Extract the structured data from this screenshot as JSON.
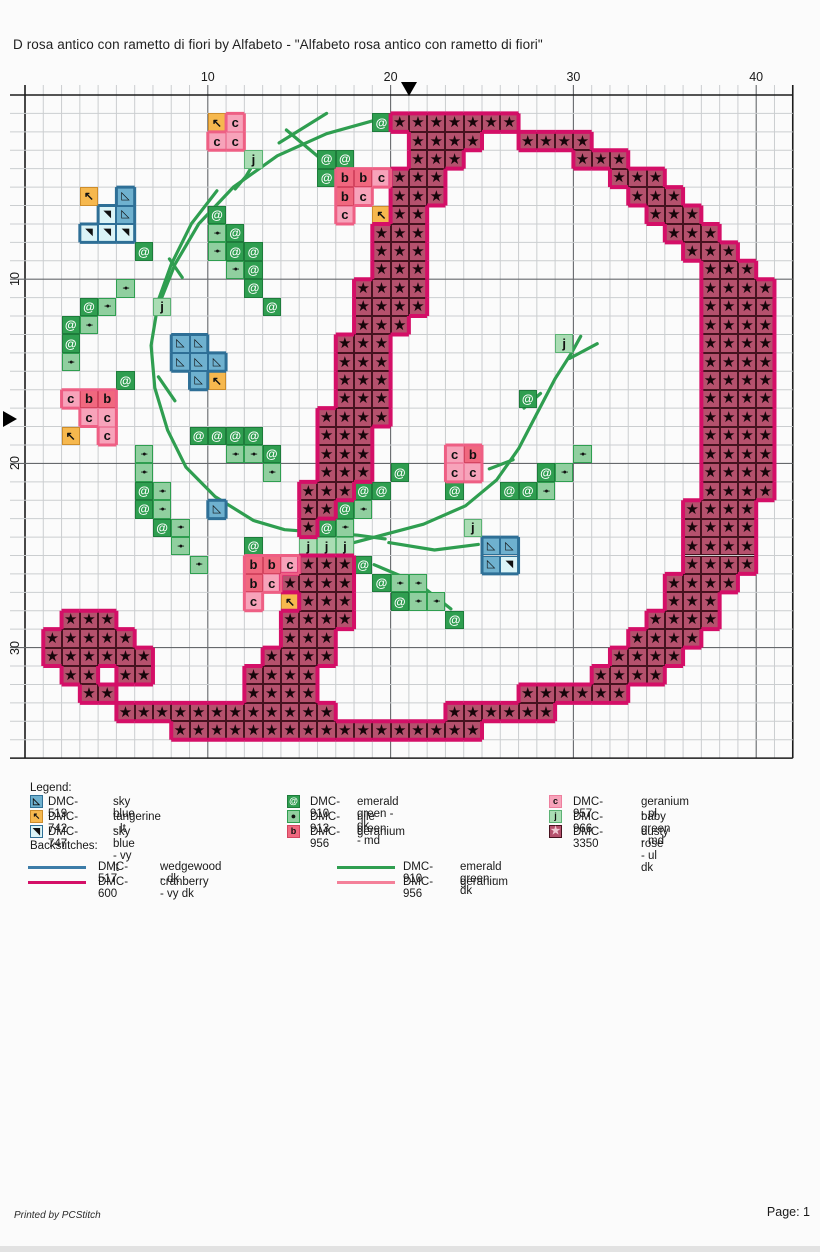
{
  "title": "D rosa antico con rametto di fiori by Alfabeto - \"Alfabeto rosa antico con rametto di fiori\"",
  "chart": {
    "grid": {
      "cols": 42,
      "rows": 36,
      "origin_x": 25,
      "origin_y": 95,
      "cell_w": 18.28,
      "cell_h": 18.42,
      "ruler_top": [
        10,
        20,
        30,
        40
      ],
      "ruler_left": [
        10,
        20,
        30
      ],
      "center_col": 21,
      "center_row": 17.6,
      "minor_line_color": "#cbced0",
      "major_line_color": "#66696c",
      "border_color": "#1c1c1c"
    },
    "palette": {
      "*": {
        "dmc": "DMC-3350",
        "fill": "#b5516d",
        "border": "#46121f",
        "sym": "★",
        "symColor": "#16050a",
        "size": 15,
        "weight": 400
      },
      "c": {
        "dmc": "DMC-957",
        "fill": "#f7a3ba",
        "border": "#ee7f9e",
        "sym": "c",
        "symColor": "#111111",
        "size": 13,
        "weight": 700
      },
      "b": {
        "dmc": "DMC-956",
        "fill": "#f0687f",
        "border": "#d44560",
        "sym": "b",
        "symColor": "#111111",
        "size": 13,
        "weight": 700
      },
      "e": {
        "dmc": "DMC-910",
        "fill": "#2f9e50",
        "border": "#1d7c3b",
        "sym": "@",
        "symColor": "#ffffff",
        "size": 12,
        "weight": 700
      },
      "n": {
        "dmc": "DMC-913",
        "fill": "#90cf9f",
        "border": "#2f9e50",
        "sym": "-●-",
        "symColor": "#111111",
        "size": 7,
        "weight": 700
      },
      "j": {
        "dmc": "DMC-966",
        "fill": "#aaddb4",
        "border": "#5cb274",
        "sym": "j",
        "symColor": "#111111",
        "size": 13,
        "weight": 700
      },
      "A": {
        "dmc": "DMC-519",
        "fill": "#6fb1cf",
        "border": "#2e6f96",
        "sym": "◺",
        "symColor": "#111111",
        "size": 11,
        "weight": 400
      },
      "V": {
        "dmc": "DMC-747",
        "fill": "#dbf4f7",
        "border": "#2e6f96",
        "sym": "◥",
        "symColor": "#111111",
        "size": 10,
        "weight": 400
      },
      "t": {
        "dmc": "DMC-742",
        "fill": "#f6b84e",
        "border": "#cd8d2c",
        "sym": "↖",
        "symColor": "#111111",
        "size": 12,
        "weight": 700
      }
    },
    "outline_groups": [
      {
        "name": "cranberry-outline",
        "keys": [
          "*"
        ],
        "color": "#d40f67",
        "width": 4
      },
      {
        "name": "wedgewood-outline",
        "keys": [
          "A",
          "V"
        ],
        "color": "#2e6f96",
        "width": 3
      },
      {
        "name": "geranium-outline",
        "keys": [
          "c",
          "b"
        ],
        "color": "#ee5f84",
        "width": 3
      }
    ],
    "pattern_rows": [
      "..........................................",
      "..........tc.......e*******...............",
      "..........cc.........****..****...........",
      "............j...ee...***......***.........",
      "................ebbc***.........***.......",
      "...t.A...........bc.***..........***......",
      "....VA....e......c.t**............***.....",
      "...VVV....ne.......***.............***....",
      "......e...nee......***..............***...",
      "...........ne......***...............***..",
      ".....n......e.....****...............****.",
      "...en..j.....e....****...............****.",
      "..en..............***................****.",
      "..e.....AA.......***.........j.......****.",
      "..n.....AAA......***.................****.",
      ".....e...At......***.................****.",
      "..cbb............***.......e.........****.",
      "...cc...........****.................****.",
      "..t.c....eeee...***..................****.",
      "......n....nne..***....cb.....n......****.",
      "......n......n..***.e..cc...en.......****.",
      "......en.......***ee...e..een........****.",
      "......en..A....**en.................****..",
      ".......en......*en......j...........****..",
      "........n...e..jjj.......AA.........****..",
      ".........n..bbc***e......AV.........****..",
      "............bc****.enn.............****...",
      "............c.t***..enn............***....",
      "..***.........****.....e..........****....",
      ".*****........***................****.....",
      ".******......****...............****......",
      "..**.**.....****...............****.......",
      "...**.......****...........******.........",
      ".....************......******.............",
      "........*****************.................",
      ".........................................."
    ],
    "backstitch_color": "#2f9e50",
    "backstitch_width": 3.2,
    "backstitch_paths": [
      [
        [
          19.4,
          1.3
        ],
        [
          16.5,
          2.1
        ],
        [
          13.8,
          3.3
        ],
        [
          11.4,
          5.0
        ],
        [
          9.5,
          7.0
        ],
        [
          8.2,
          9.2
        ],
        [
          7.4,
          11.2
        ]
      ],
      [
        [
          10.5,
          5.2
        ],
        [
          9.1,
          7.0
        ],
        [
          8.0,
          9.2
        ],
        [
          7.2,
          11.4
        ]
      ],
      [
        [
          7.3,
          11.2
        ],
        [
          6.9,
          13.6
        ],
        [
          7.1,
          15.9
        ],
        [
          7.8,
          18.2
        ],
        [
          8.8,
          20.2
        ],
        [
          10.4,
          21.8
        ],
        [
          12.5,
          23.1
        ],
        [
          14.2,
          23.6
        ],
        [
          18.2,
          23.9
        ],
        [
          19.7,
          24.1
        ]
      ],
      [
        [
          15.3,
          24.7
        ],
        [
          18.0,
          24.3
        ],
        [
          21.8,
          23.3
        ],
        [
          24.1,
          22.3
        ],
        [
          25.8,
          20.9
        ],
        [
          27.0,
          19.2
        ],
        [
          28.0,
          17.3
        ],
        [
          29.0,
          15.4
        ],
        [
          29.9,
          14.0
        ],
        [
          30.4,
          13.1
        ]
      ],
      [
        [
          19.9,
          24.3
        ],
        [
          22.4,
          24.7
        ],
        [
          24.8,
          24.4
        ]
      ],
      [
        [
          19.1,
          25.5
        ],
        [
          21.5,
          26.5
        ],
        [
          23.3,
          27.9
        ]
      ],
      [
        [
          16.5,
          1.0
        ],
        [
          13.9,
          2.6
        ]
      ],
      [
        [
          14.3,
          1.9
        ],
        [
          16.1,
          3.4
        ]
      ],
      [
        [
          29.8,
          14.3
        ],
        [
          31.3,
          13.5
        ]
      ],
      [
        [
          28.2,
          16.2
        ],
        [
          27.3,
          17.0
        ]
      ],
      [
        [
          26.7,
          19.8
        ],
        [
          25.4,
          20.3
        ]
      ],
      [
        [
          12.7,
          3.4
        ],
        [
          12.1,
          4.4
        ],
        [
          11.5,
          5.1
        ]
      ],
      [
        [
          7.9,
          8.9
        ],
        [
          8.6,
          9.9
        ]
      ],
      [
        [
          7.3,
          15.3
        ],
        [
          8.2,
          16.6
        ]
      ]
    ]
  },
  "legend": {
    "heading": "Legend:",
    "backstitch_heading": "Backstitches:",
    "columns": [
      {
        "x_swatch": 30,
        "x_code": 48,
        "x_name": 113,
        "items": [
          {
            "code": "DMC-519",
            "name": "sky blue",
            "key": "A"
          },
          {
            "code": "DMC-742",
            "name": "tangerine - lt",
            "key": "t"
          },
          {
            "code": "DMC-747",
            "name": "sky blue - vy lt",
            "key": "V"
          }
        ]
      },
      {
        "x_swatch": 287,
        "x_code": 310,
        "x_name": 357,
        "items": [
          {
            "code": "DMC-910",
            "name": "emerald green - dk",
            "key": "e"
          },
          {
            "code": "DMC-913",
            "name": "nile green - md",
            "key": "n"
          },
          {
            "code": "DMC-956",
            "name": "geranium",
            "key": "b"
          }
        ]
      },
      {
        "x_swatch": 549,
        "x_code": 573,
        "x_name": 641,
        "items": [
          {
            "code": "DMC-957",
            "name": "geranium - pl",
            "key": "c"
          },
          {
            "code": "DMC-966",
            "name": "baby green - md",
            "key": "j"
          },
          {
            "code": "DMC-3350",
            "name": "dusty rose - ul dk",
            "key": "*"
          }
        ]
      }
    ],
    "backstitch_columns": [
      {
        "x_line": 28,
        "x_code": 98,
        "x_name": 160,
        "items": [
          {
            "code": "DMC-517",
            "name": "wedgewood - dk",
            "color": "#3c7ca8"
          },
          {
            "code": "DMC-600",
            "name": "cranberry - vy dk",
            "color": "#d40f67"
          }
        ]
      },
      {
        "x_line": 337,
        "x_code": 403,
        "x_name": 460,
        "items": [
          {
            "code": "DMC-910",
            "name": "emerald green - dk",
            "color": "#2f9e50"
          },
          {
            "code": "DMC-956",
            "name": "geranium",
            "color": "#f48099"
          }
        ]
      }
    ]
  },
  "footer": {
    "printed_by": "Printed by PCStitch",
    "page": "Page: 1"
  }
}
